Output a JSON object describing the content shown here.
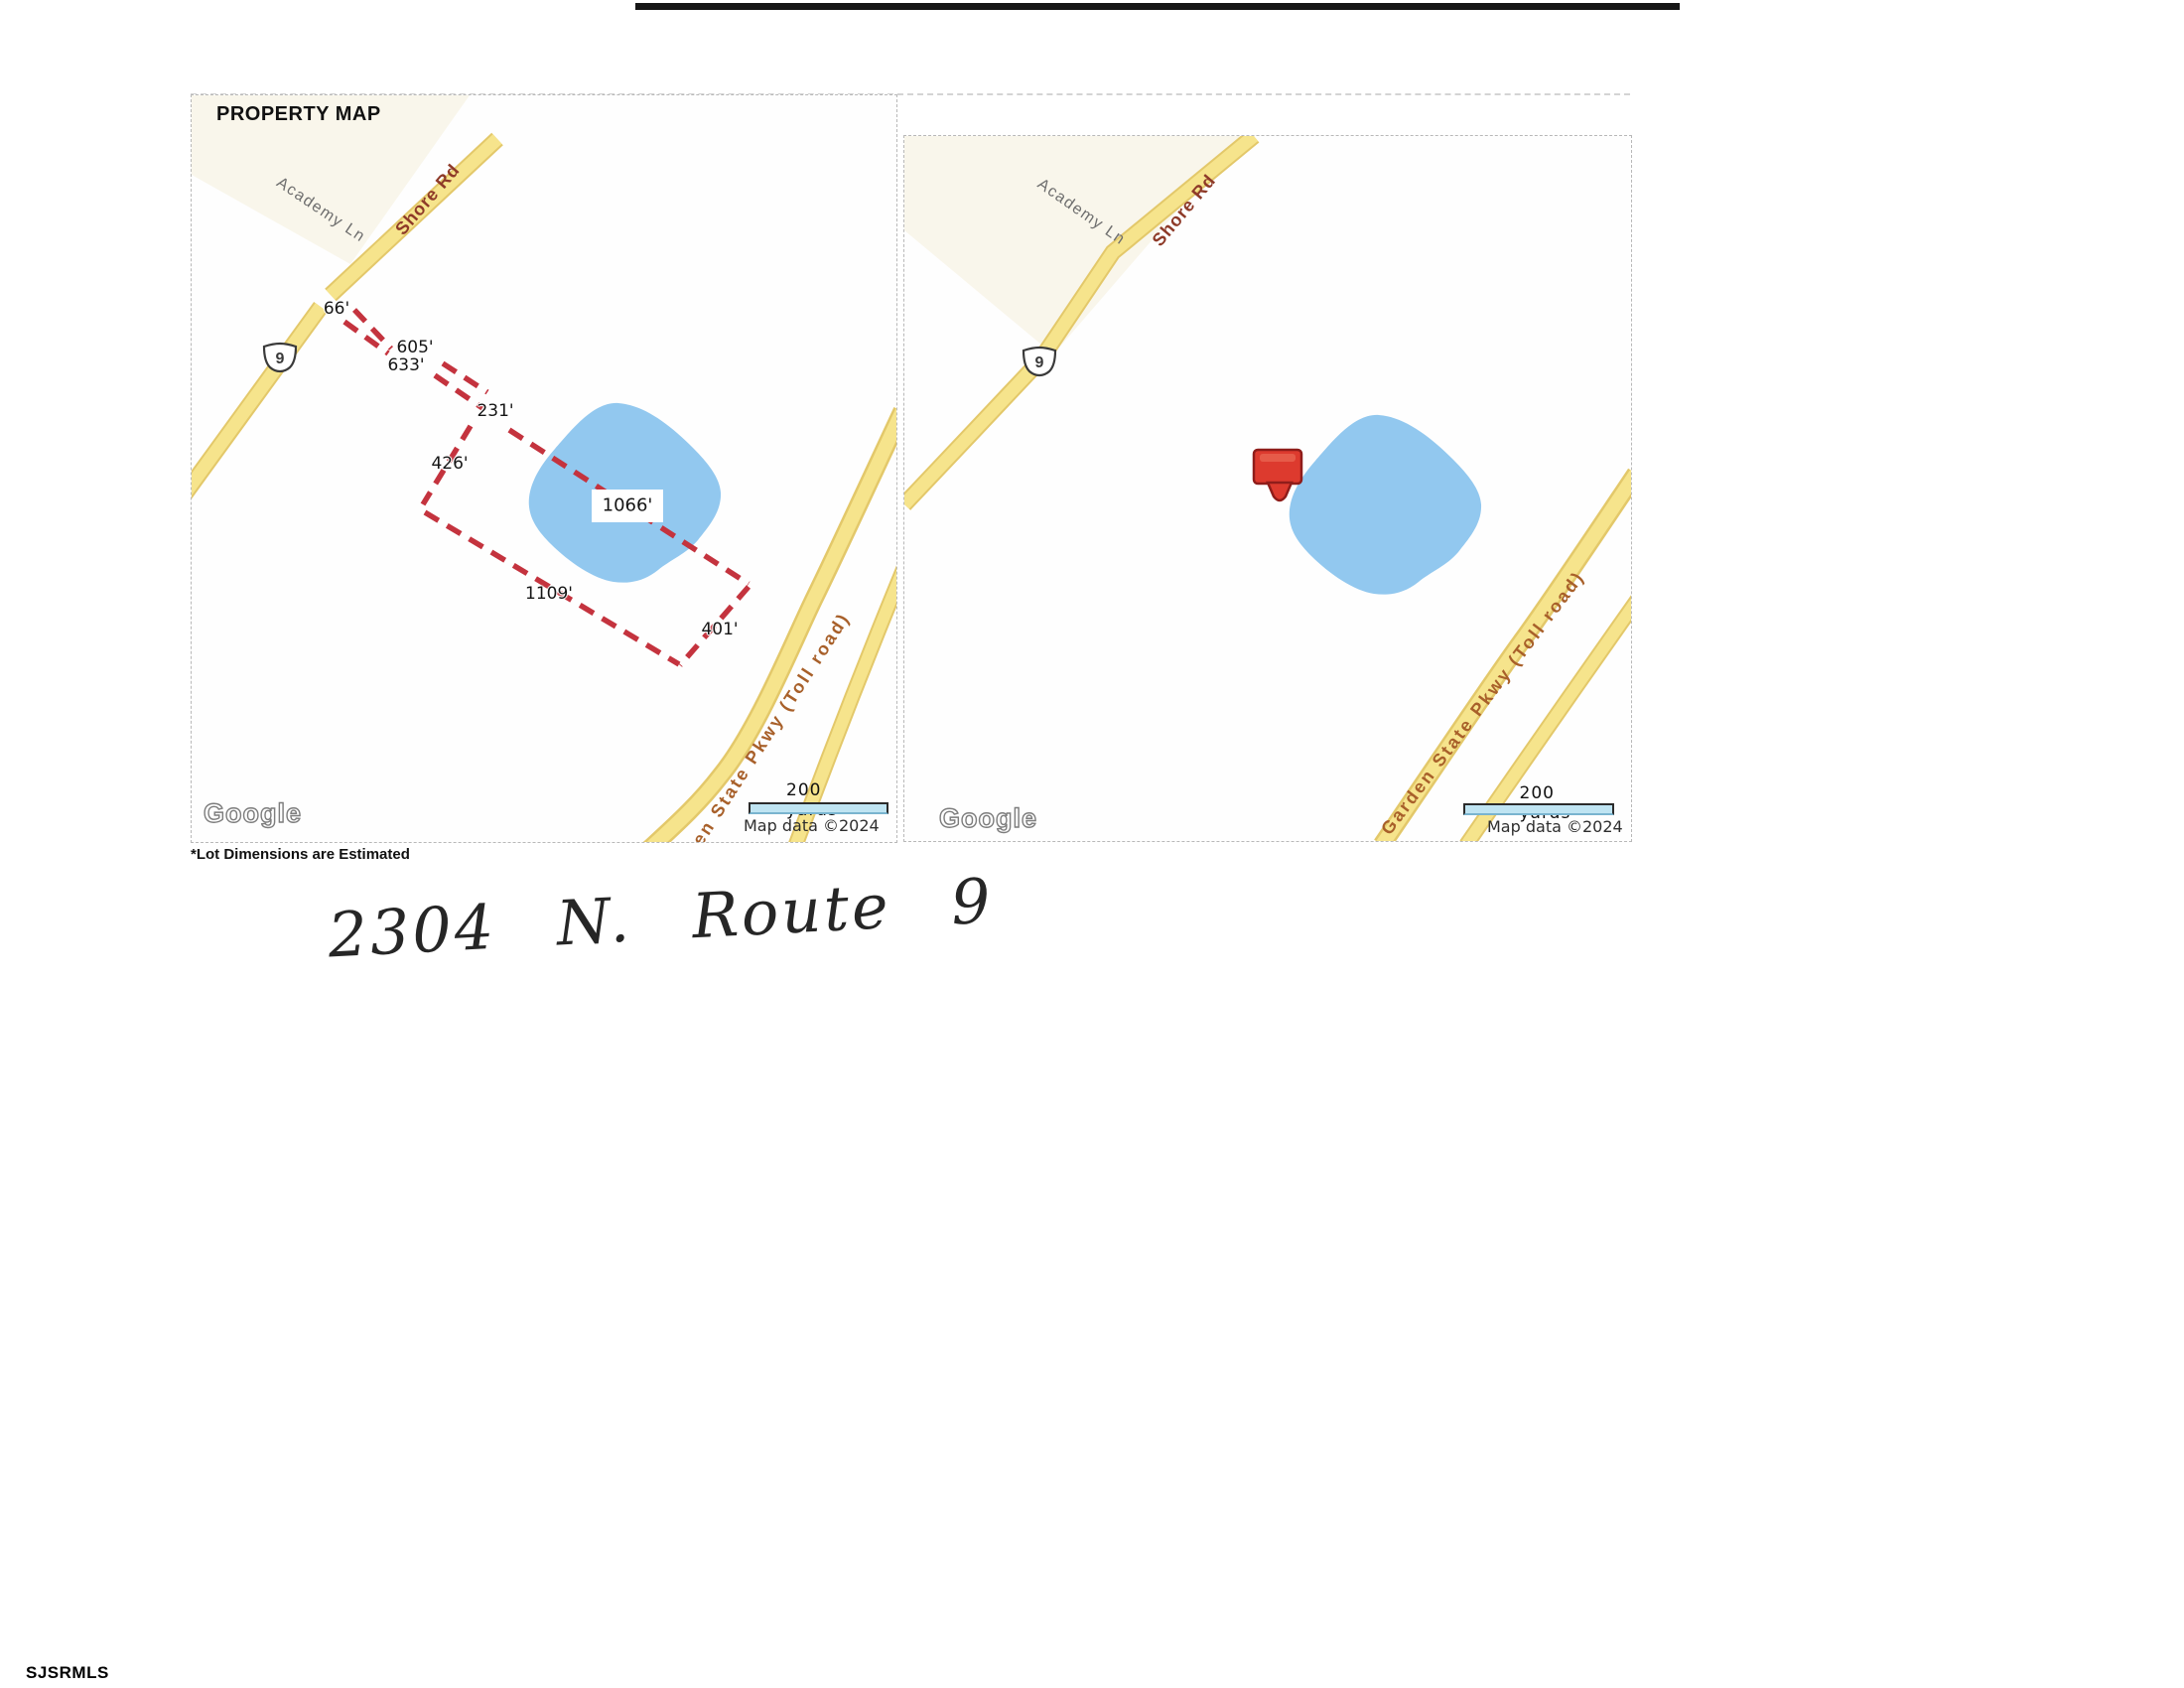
{
  "document": {
    "title": "PROPERTY MAP",
    "footnote": "*Lot Dimensions are Estimated",
    "handwritten_address": "2304 N. Route 9",
    "mls_watermark": "SJSRMLS"
  },
  "maps": {
    "shared": {
      "google_logo": "Google",
      "scale_label": "200 yards",
      "attribution": "Map data ©2024"
    },
    "left": {
      "description": "property lot outline map",
      "road_labels": {
        "academy": "Academy Ln",
        "shore": "Shore Rd",
        "parkway": "Garden State Pkwy (Toll road)",
        "route_shield": "9"
      },
      "lot_dimensions": {
        "front": "66'",
        "side_upper": "605'",
        "side_lower": "633'",
        "step": "231'",
        "west": "426'",
        "north": "1066'",
        "south": "1109'",
        "east": "401'"
      }
    },
    "right": {
      "description": "location map with marker",
      "road_labels": {
        "academy": "Academy Ln",
        "shore": "Shore Rd",
        "parkway": "Garden State Pkwy (Toll road)",
        "route_shield": "9"
      },
      "marker_icon": "red-location-marker"
    }
  },
  "colors": {
    "road_yellow": "#f6e48c",
    "road_edge": "#e3c86a",
    "water_blue": "#8cc5ee",
    "boundary_red": "#c4333e",
    "marker_red": "#dd3a2e",
    "shore_label": "#8e3a28",
    "parkway_label": "#a8602a"
  }
}
